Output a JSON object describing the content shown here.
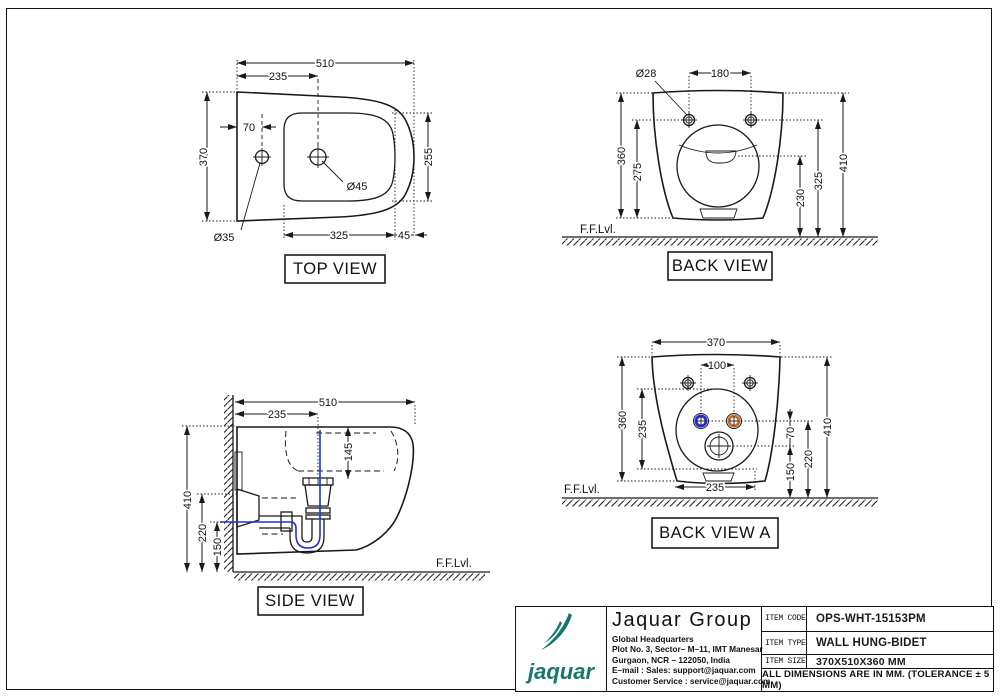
{
  "views": {
    "top": {
      "label": "TOP VIEW",
      "dims": {
        "overall_width": "510",
        "left_to_drain": "235",
        "tap_hole_offset": "70",
        "overall_depth": "370",
        "basin_depth": "255",
        "basin_length": "325",
        "front_margin": "45",
        "drain_hole_dia": "Ø45",
        "tap_hole_dia": "Ø35"
      }
    },
    "back": {
      "label": "BACK VIEW",
      "ffl": "F.F.Lvl.",
      "dims": {
        "fixing_hole_dia": "Ø28",
        "fixing_hole_spacing": "180",
        "body_height": "360",
        "fixing_to_bottom": "275",
        "outlet_center_height": "230",
        "fixing_hole_height": "325",
        "overall_height": "410"
      }
    },
    "side": {
      "label": "SIDE VIEW",
      "ffl": "F.F.Lvl.",
      "dims": {
        "overall_length": "510",
        "wall_to_drain": "235",
        "basin_depth": "145",
        "overall_height": "410",
        "outlet_height": "220",
        "pipe_height": "150"
      }
    },
    "back_a": {
      "label": "BACK VIEW A",
      "ffl": "F.F.Lvl.",
      "dims": {
        "body_width": "370",
        "inlet_spacing": "100",
        "body_height": "360",
        "circle_span": "235",
        "inlet_to_drain": "70",
        "drain_height": "150",
        "inlet_height": "220",
        "overall_height": "410",
        "bottom_width": "235"
      }
    }
  },
  "title_block": {
    "logo_word": "jaquar",
    "company_name": "Jaquar Group",
    "address_lines": [
      "Global Headquarters",
      "Plot No. 3, Sector– M–11, IMT Manesar",
      "Gurgaon, NCR – 122050, India",
      "E–mail : Sales: support@jaquar.com",
      "Customer Service : service@jaquar.com"
    ],
    "fields": [
      {
        "label": "ITEM CODE",
        "value": "OPS-WHT-15153PM"
      },
      {
        "label": "ITEM TYPE",
        "value": "WALL HUNG-BIDET"
      },
      {
        "label": "ITEM SIZE",
        "value": "370X510X360 MM"
      }
    ],
    "note": "ALL DIMENSIONS ARE IN MM. (TOLERANCE ± 5 MM)"
  },
  "colors": {
    "line": "#1a1a1a",
    "cold_water": "#2430d6",
    "hot_water": "#cc6e33",
    "brand_teal": "#17776b"
  }
}
